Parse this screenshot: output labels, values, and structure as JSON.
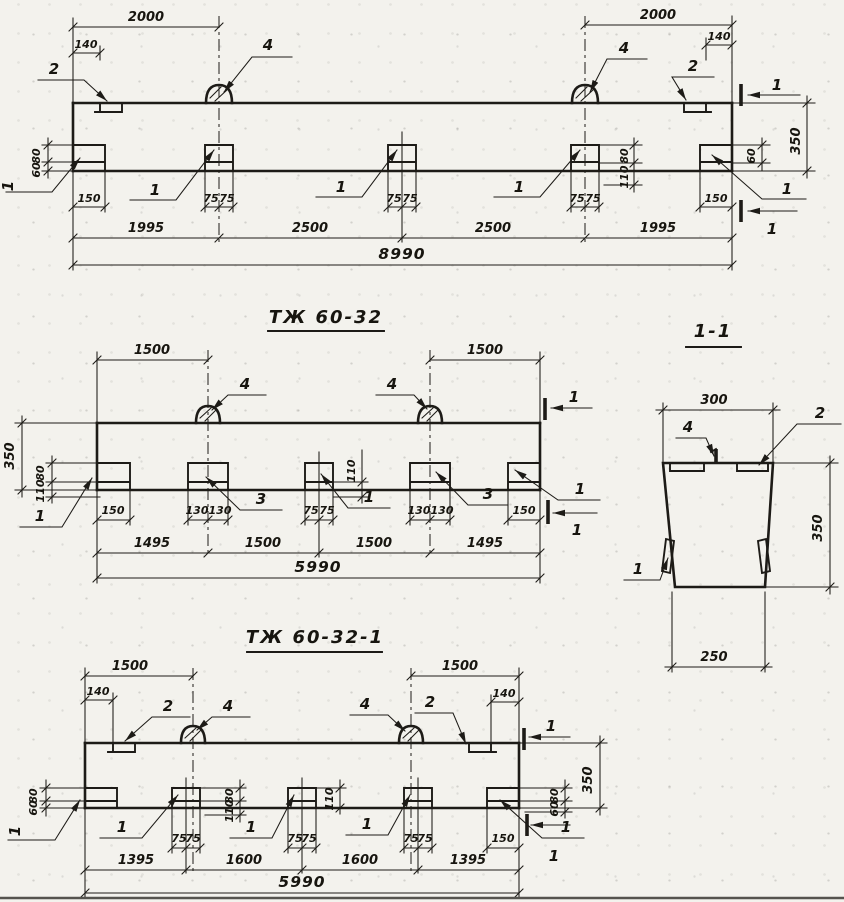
{
  "sheet": {
    "titles": {
      "middle_view": "ТЖ 60-32",
      "bottom_view": "ТЖ 60-32-1",
      "section_view": "1-1"
    },
    "detail_labels": {
      "d1": "1",
      "d2": "2",
      "d3": "3",
      "d4": "4"
    },
    "section_mark": "1",
    "top_view": {
      "span": "2000",
      "end_offset": "140",
      "plate_height": "80",
      "plate_gap": "60",
      "stud_height": "80",
      "stud_gap": "110",
      "beam_height": "350",
      "end_gap": "60",
      "end_plate_width": "150",
      "stud_half": "75",
      "segment_end": "1995",
      "segment_mid": "2500",
      "total_length": "8990"
    },
    "middle_view": {
      "span": "1500",
      "beam_height": "350",
      "plate_height": "80",
      "plate_gap": "110",
      "stud_gap": "110",
      "end_plate_width": "150",
      "stud_wide_half": "130",
      "stud_half": "75",
      "segment_end": "1495",
      "segment_mid": "1500",
      "total_length": "5990"
    },
    "bottom_view": {
      "span": "1500",
      "end_offset": "140",
      "plate_height": "80",
      "plate_gap": "60",
      "stud_height": "80",
      "stud_gap": "110",
      "beam_height": "350",
      "end_plate_width": "150",
      "stud_half": "75",
      "segment_end": "1395",
      "segment_mid": "1600",
      "total_length": "5990"
    },
    "section_view": {
      "top_width": "300",
      "bottom_width": "250",
      "height": "350"
    }
  }
}
